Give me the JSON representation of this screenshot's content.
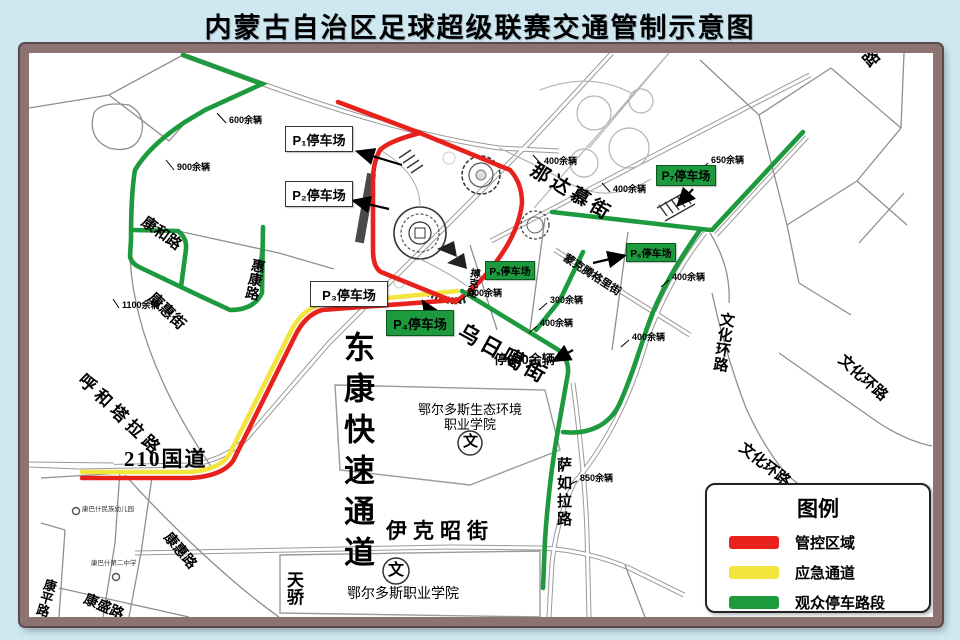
{
  "title": "内蒙古自治区足球超级联赛交通管制示意图",
  "legend": {
    "title": "图例",
    "items": [
      {
        "label": "管控区域",
        "color": "#e8211d"
      },
      {
        "label": "应急通道",
        "color": "#f3e53d"
      },
      {
        "label": "观众停车路段",
        "color": "#1d9a3e"
      }
    ]
  },
  "parking": {
    "p1": "P₁停车场",
    "p2": "P₂停车场",
    "p3": "P₃停车场",
    "p4": "P₄停车场",
    "p5": "P₅停车场",
    "p6": "P₆停车场",
    "p7": "P₇停车场"
  },
  "roads": {
    "kanghe": "康和路",
    "huikang": "惠康路",
    "kanghui_jie": "康惠街",
    "huhetala": "呼和塔拉路",
    "g210": "210国道",
    "dongkang": "东康快速通道",
    "kanghui_lu": "康惠路",
    "kangping": "康平路",
    "kangsheng": "康盛路",
    "tianjiao": "天骄",
    "yikezhao": "伊克昭街",
    "sarula": "萨如拉路",
    "wuriga": "乌日噶街",
    "nadamu": "那达慕街",
    "mengke": "蒙克腾格里街",
    "boke": "搏克路",
    "wenhua": "文化环路",
    "lu": "路"
  },
  "capacities": {
    "c600": "600余辆",
    "c900": "900余辆",
    "c1100": "1100余辆",
    "c650": "650余辆",
    "c850": "850余辆",
    "c300": "300余辆",
    "c400": "400余辆",
    "c800": "停800余辆"
  },
  "landmarks": {
    "eco1": "鄂尔多斯生态环境",
    "eco2": "职业学院",
    "voc": "鄂尔多斯职业学院",
    "wen": "文",
    "kindergarten": "康巴什民族幼儿园",
    "school": "康巴什第二中学"
  }
}
